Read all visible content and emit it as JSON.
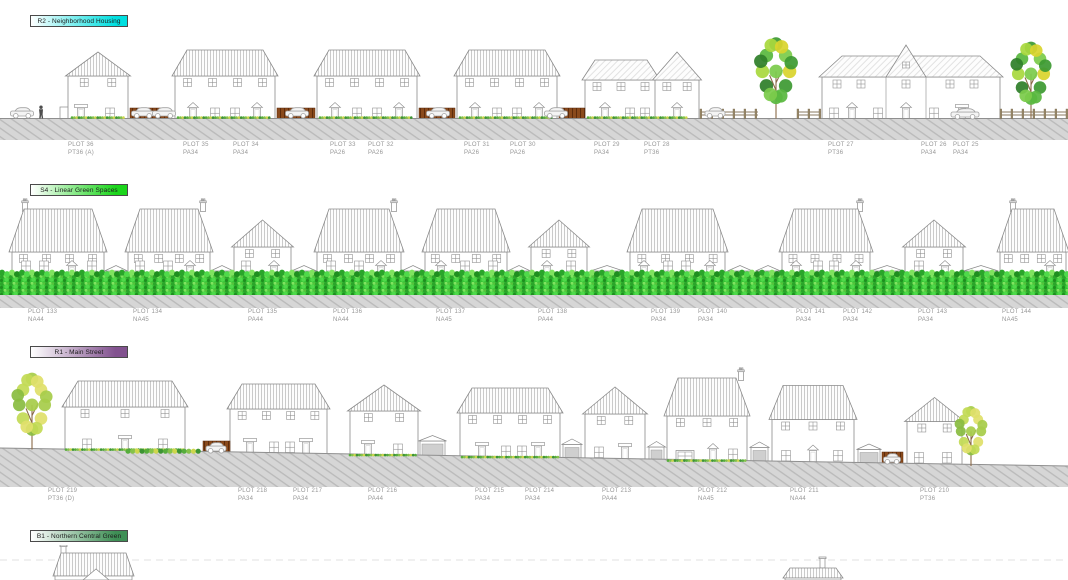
{
  "sections": [
    {
      "id": "R2",
      "banner": {
        "label": "R2 - Neighborhood Housing",
        "color": "#00dfe0"
      },
      "plots": [
        {
          "plot": "PLOT 36",
          "type": "PT36 (A)"
        },
        {
          "plot": "PLOT 35",
          "type": "PA34"
        },
        {
          "plot": "PLOT 34",
          "type": "PA34"
        },
        {
          "plot": "PLOT 33",
          "type": "PA26"
        },
        {
          "plot": "PLOT 32",
          "type": "PA26"
        },
        {
          "plot": "PLOT 31",
          "type": "PA26"
        },
        {
          "plot": "PLOT 30",
          "type": "PA26"
        },
        {
          "plot": "PLOT 29",
          "type": "PA34"
        },
        {
          "plot": "PLOT 28",
          "type": "PT36"
        },
        {
          "plot": "PLOT 27",
          "type": "PT36"
        },
        {
          "plot": "PLOT 26",
          "type": "PA34"
        },
        {
          "plot": "PLOT 25",
          "type": "PA34"
        }
      ]
    },
    {
      "id": "S4",
      "banner": {
        "label": "S4 - Linear Green Spaces",
        "color": "#1bd51b"
      },
      "plots": [
        {
          "plot": "PLOT 133",
          "type": "NA44"
        },
        {
          "plot": "PLOT 134",
          "type": "NA45"
        },
        {
          "plot": "PLOT 135",
          "type": "PA44"
        },
        {
          "plot": "PLOT 136",
          "type": "NA44"
        },
        {
          "plot": "PLOT 137",
          "type": "NA45"
        },
        {
          "plot": "PLOT 138",
          "type": "PA44"
        },
        {
          "plot": "PLOT 139",
          "type": "PA34"
        },
        {
          "plot": "PLOT 140",
          "type": "PA34"
        },
        {
          "plot": "PLOT 141",
          "type": "PA34"
        },
        {
          "plot": "PLOT 142",
          "type": "PA34"
        },
        {
          "plot": "PLOT 143",
          "type": "PA34"
        },
        {
          "plot": "PLOT 144",
          "type": "NA45"
        }
      ]
    },
    {
      "id": "R1",
      "banner": {
        "label": "R1 - Main Street",
        "color": "#82528f"
      },
      "plots": [
        {
          "plot": "PLOT 219",
          "type": "PT36 (D)"
        },
        {
          "plot": "PLOT 218",
          "type": "PA34"
        },
        {
          "plot": "PLOT 217",
          "type": "PA34"
        },
        {
          "plot": "PLOT 216",
          "type": "PA44"
        },
        {
          "plot": "PLOT 215",
          "type": "PA34"
        },
        {
          "plot": "PLOT 214",
          "type": "PA34"
        },
        {
          "plot": "PLOT 213",
          "type": "PA44"
        },
        {
          "plot": "PLOT 212",
          "type": "NA45"
        },
        {
          "plot": "PLOT 211",
          "type": "NA44"
        },
        {
          "plot": "PLOT 210",
          "type": "PT36"
        }
      ]
    },
    {
      "id": "B1",
      "banner": {
        "label": "B1 - Northern Central Green",
        "color": "#3e8f55"
      },
      "plots": []
    }
  ]
}
